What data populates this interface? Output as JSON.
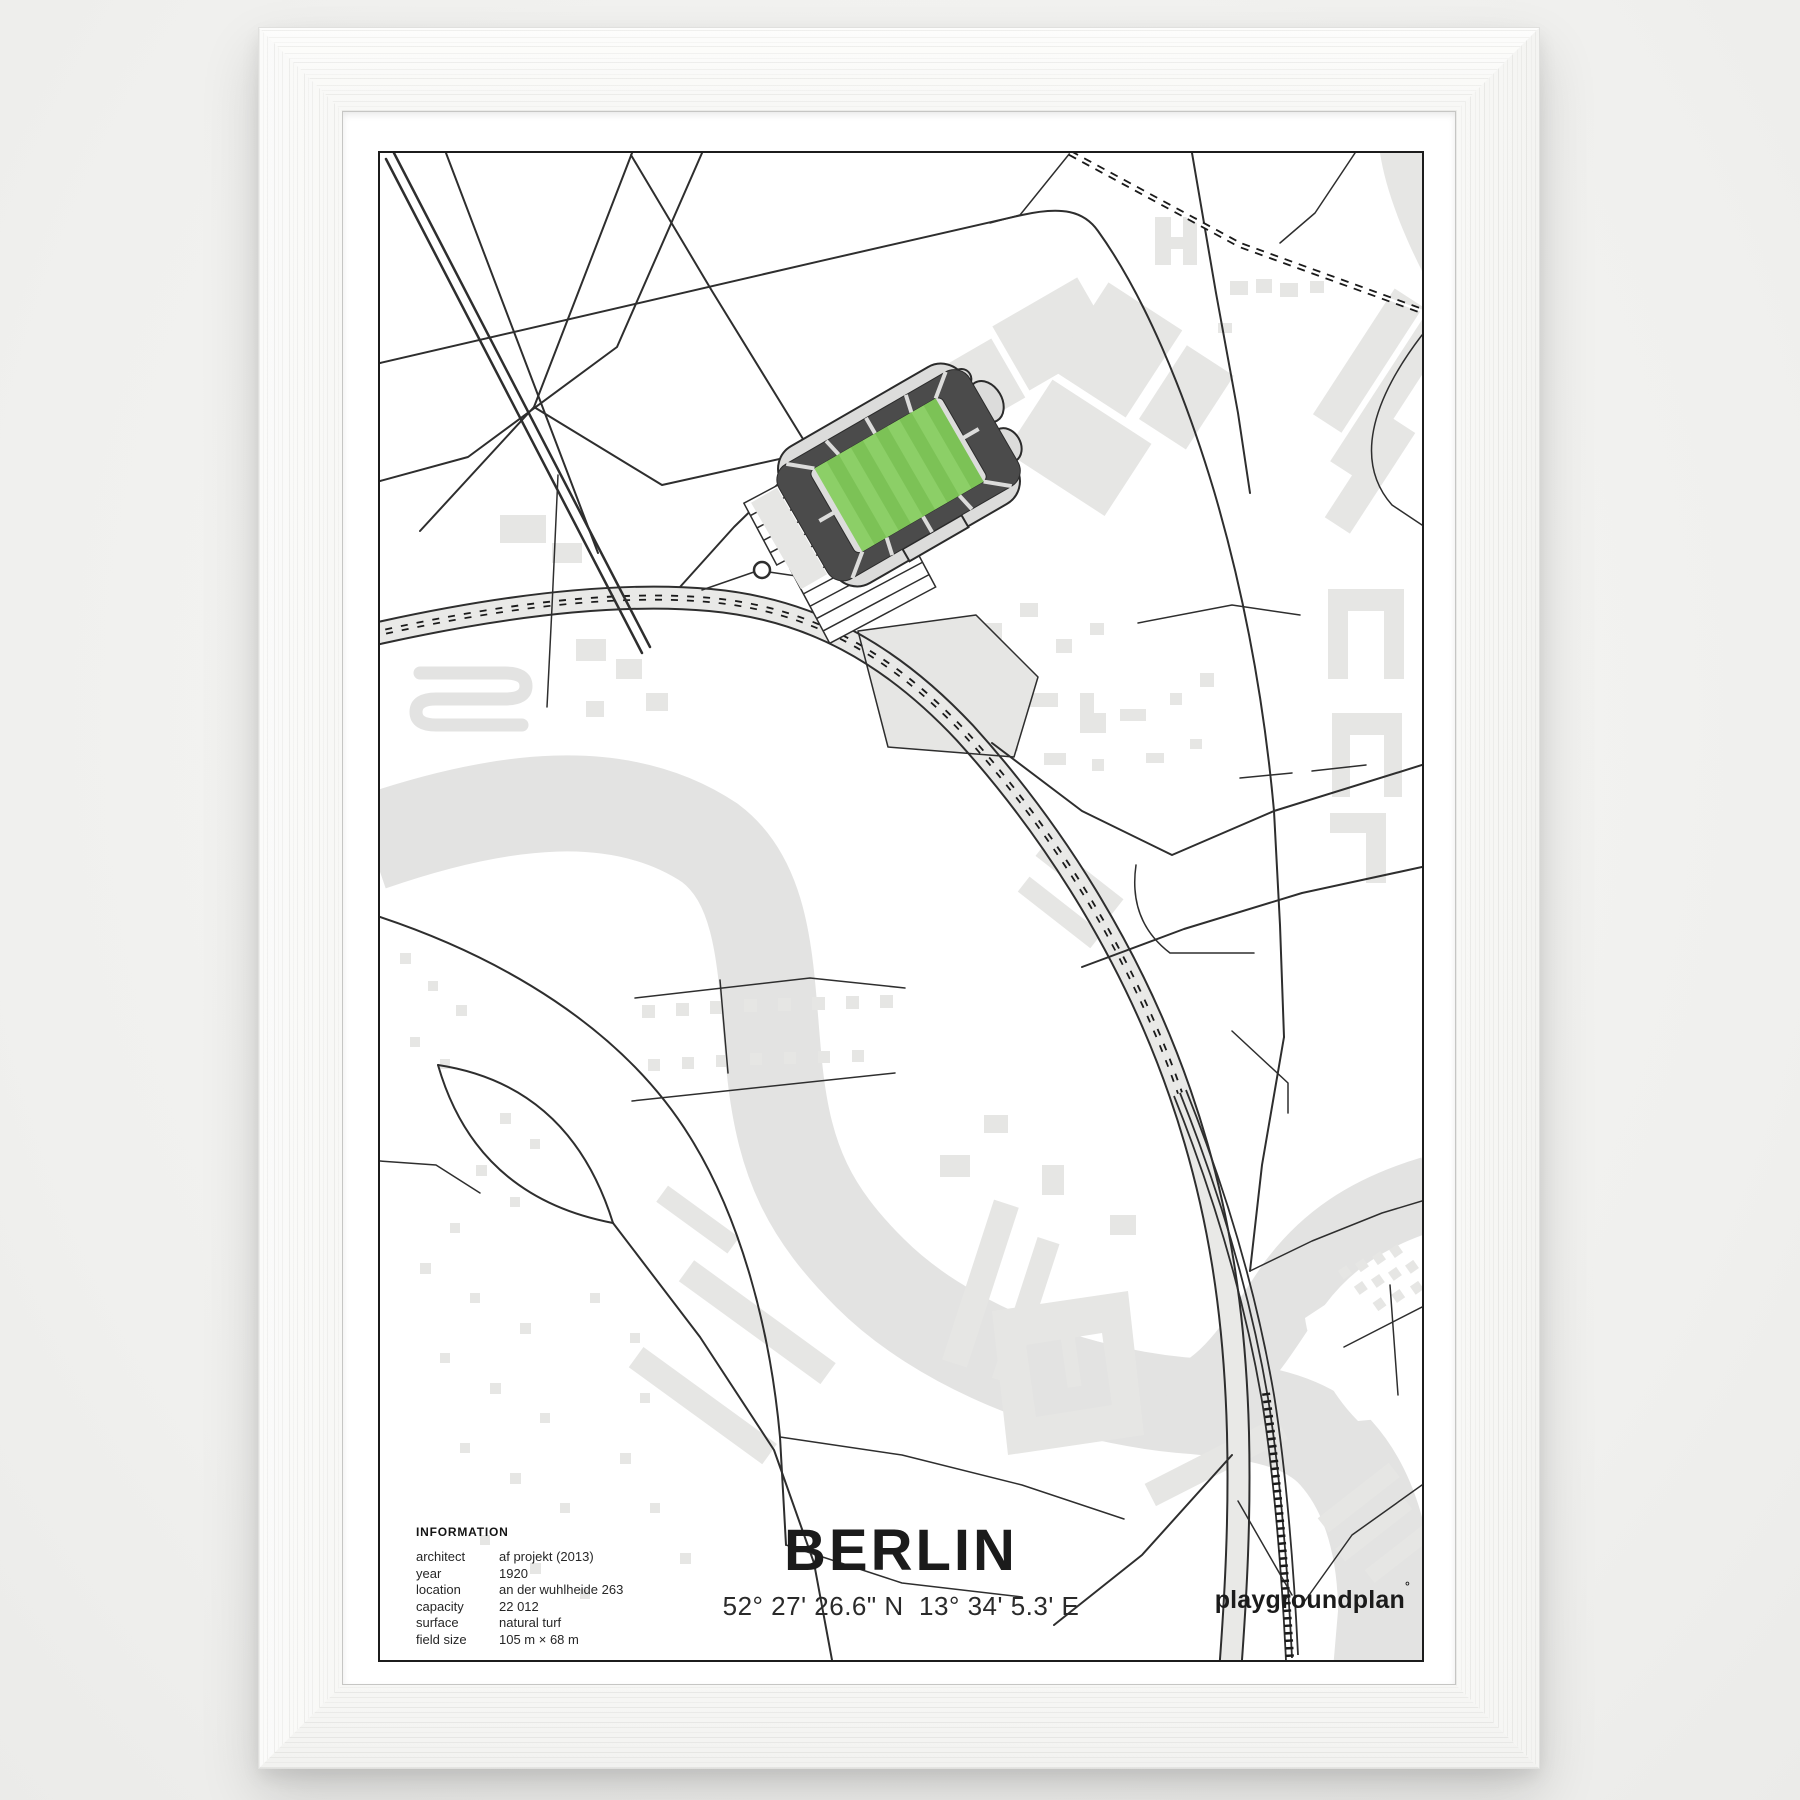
{
  "poster": {
    "title": "BERLIN",
    "coordinates": "52° 27' 26.6\" N  13° 34' 5.3' E",
    "brand": {
      "name": "playgroundplan",
      "mark": "°"
    },
    "information": {
      "heading": "INFORMATION",
      "rows": [
        {
          "label": "architect",
          "value": "af projekt (2013)"
        },
        {
          "label": "year",
          "value": "1920"
        },
        {
          "label": "location",
          "value": "an der wuhlheide 263"
        },
        {
          "label": "capacity",
          "value": "22 012"
        },
        {
          "label": "surface",
          "value": "natural turf"
        },
        {
          "label": "field size",
          "value": "105 m × 68 m"
        }
      ]
    },
    "map": {
      "subject": "stadium street map with river, railway, roads and buildings",
      "colors": {
        "river": "#e3e3e2",
        "buildings": "#e6e6e4",
        "roads": "#2e2e2e",
        "railway": "#1a1a1a",
        "road_band": "#e9e9e7",
        "pitch_stripe_light": "#8ccf67",
        "pitch_stripe_dark": "#7cc256",
        "stands": "#4b4b4b",
        "concourse": "#dcdcdb"
      }
    }
  }
}
